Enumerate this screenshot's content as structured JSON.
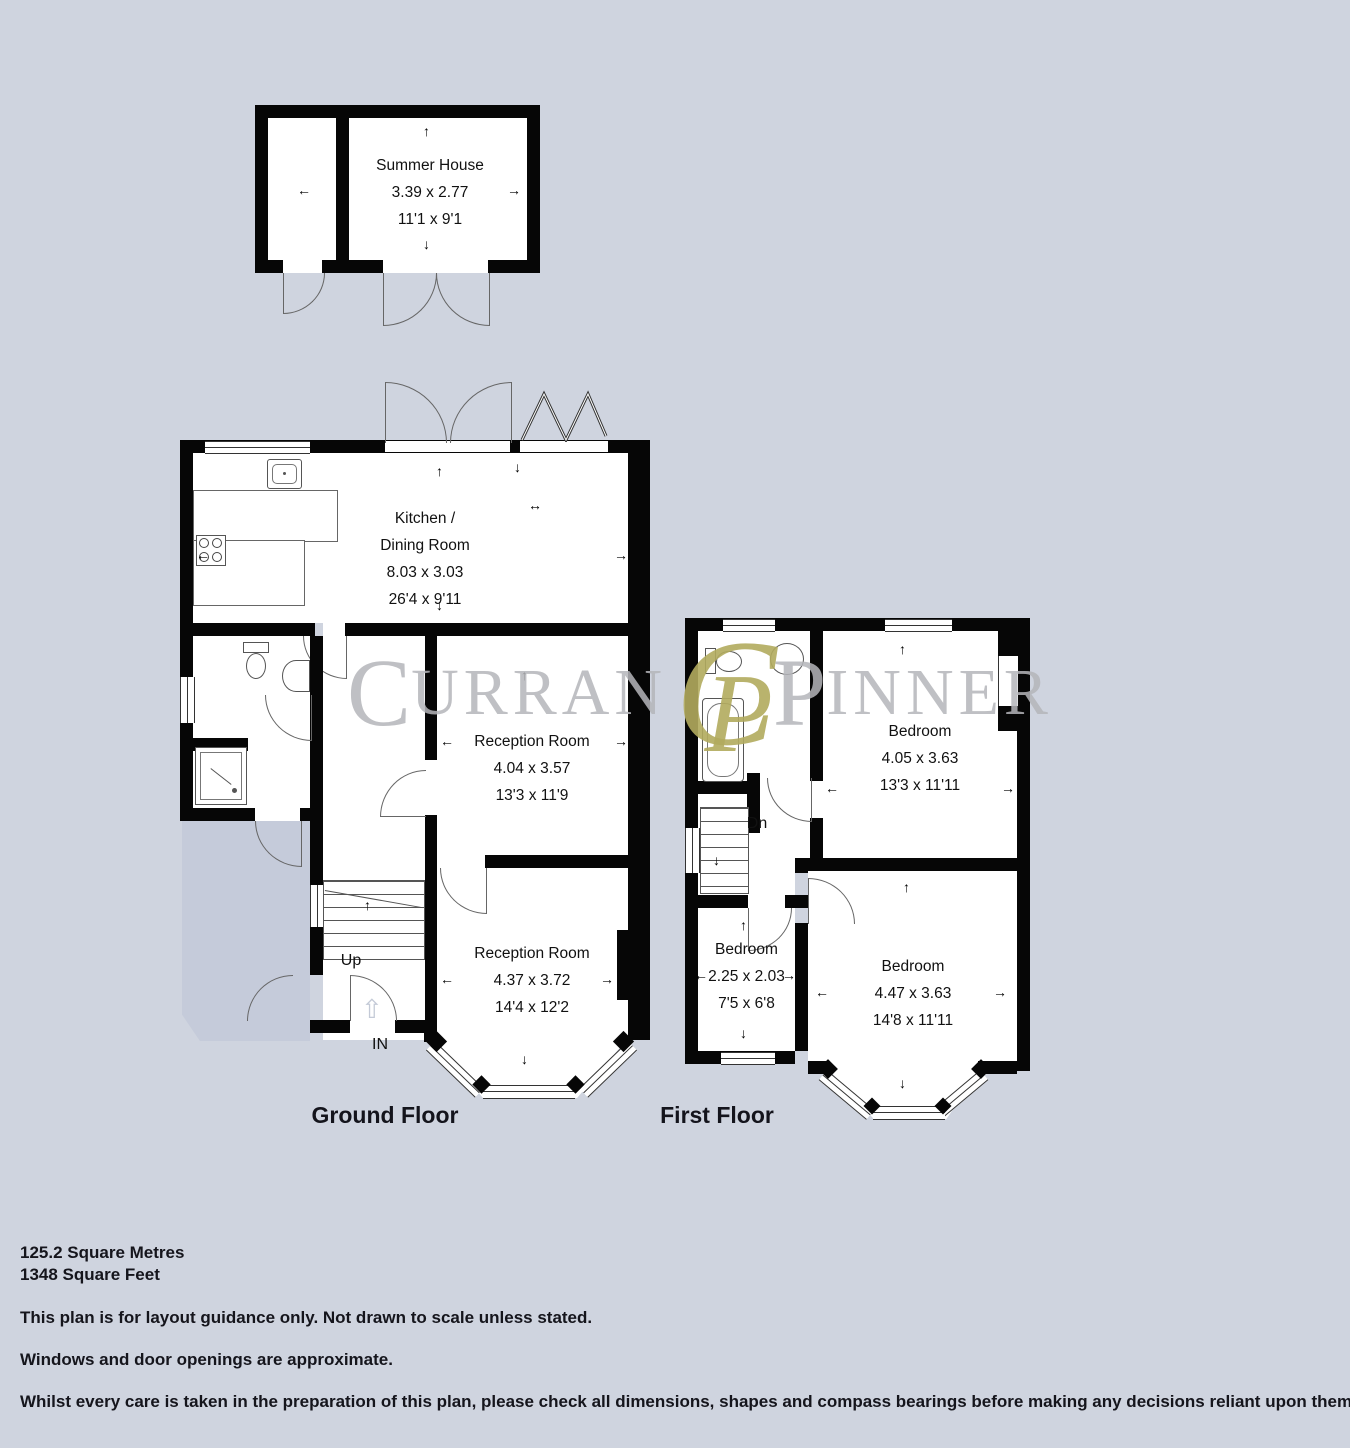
{
  "colors": {
    "background": "#cfd4df",
    "wall": "#060606",
    "patio": "#c5cbda",
    "watermark_gray": "#b5b6ba",
    "watermark_gold": "#b2ab5e"
  },
  "icons": {
    "arrow_up": "↑",
    "arrow_down": "↓",
    "arrow_left": "←",
    "arrow_right": "→",
    "arrow_both": "↔",
    "entry_arrow": "⇧"
  },
  "watermark": {
    "left_cap": "C",
    "left_rest": "URRAN",
    "mono_c": "C",
    "mono_p": "P",
    "right_cap": "P",
    "right_rest": "INNER"
  },
  "summer_house": {
    "name": "Summer House",
    "metric": "3.39 x 2.77",
    "imperial": "11'1 x 9'1"
  },
  "ground_floor": {
    "label": "Ground Floor",
    "kitchen": {
      "name_line1": "Kitchen /",
      "name_line2": "Dining Room",
      "metric": "8.03 x 3.03",
      "imperial": "26'4 x 9'11"
    },
    "reception1": {
      "name": "Reception Room",
      "metric": "4.04 x 3.57",
      "imperial": "13'3 x 11'9"
    },
    "reception2": {
      "name": "Reception Room",
      "metric": "4.37 x 3.72",
      "imperial": "14'4 x 12'2"
    },
    "stairs": "Up",
    "entrance": "IN"
  },
  "first_floor": {
    "label": "First Floor",
    "bedroom1": {
      "name": "Bedroom",
      "metric": "4.05 x 3.63",
      "imperial": "13'3 x 11'11"
    },
    "bedroom2": {
      "name": "Bedroom",
      "metric": "2.25 x 2.03",
      "imperial": "7'5 x 6'8"
    },
    "bedroom3": {
      "name": "Bedroom",
      "metric": "4.47 x 3.63",
      "imperial": "14'8 x 11'11"
    },
    "stairs": "Dn"
  },
  "footer": {
    "area_metric": "125.2 Square Metres",
    "area_imperial": "1348 Square Feet",
    "line1": "This plan is for layout guidance only. Not drawn to scale unless stated.",
    "line2": "Windows and door openings are approximate.",
    "line3": "Whilst every care is taken in the preparation of this plan, please check all dimensions, shapes and compass bearings before making any decisions reliant upon them."
  }
}
